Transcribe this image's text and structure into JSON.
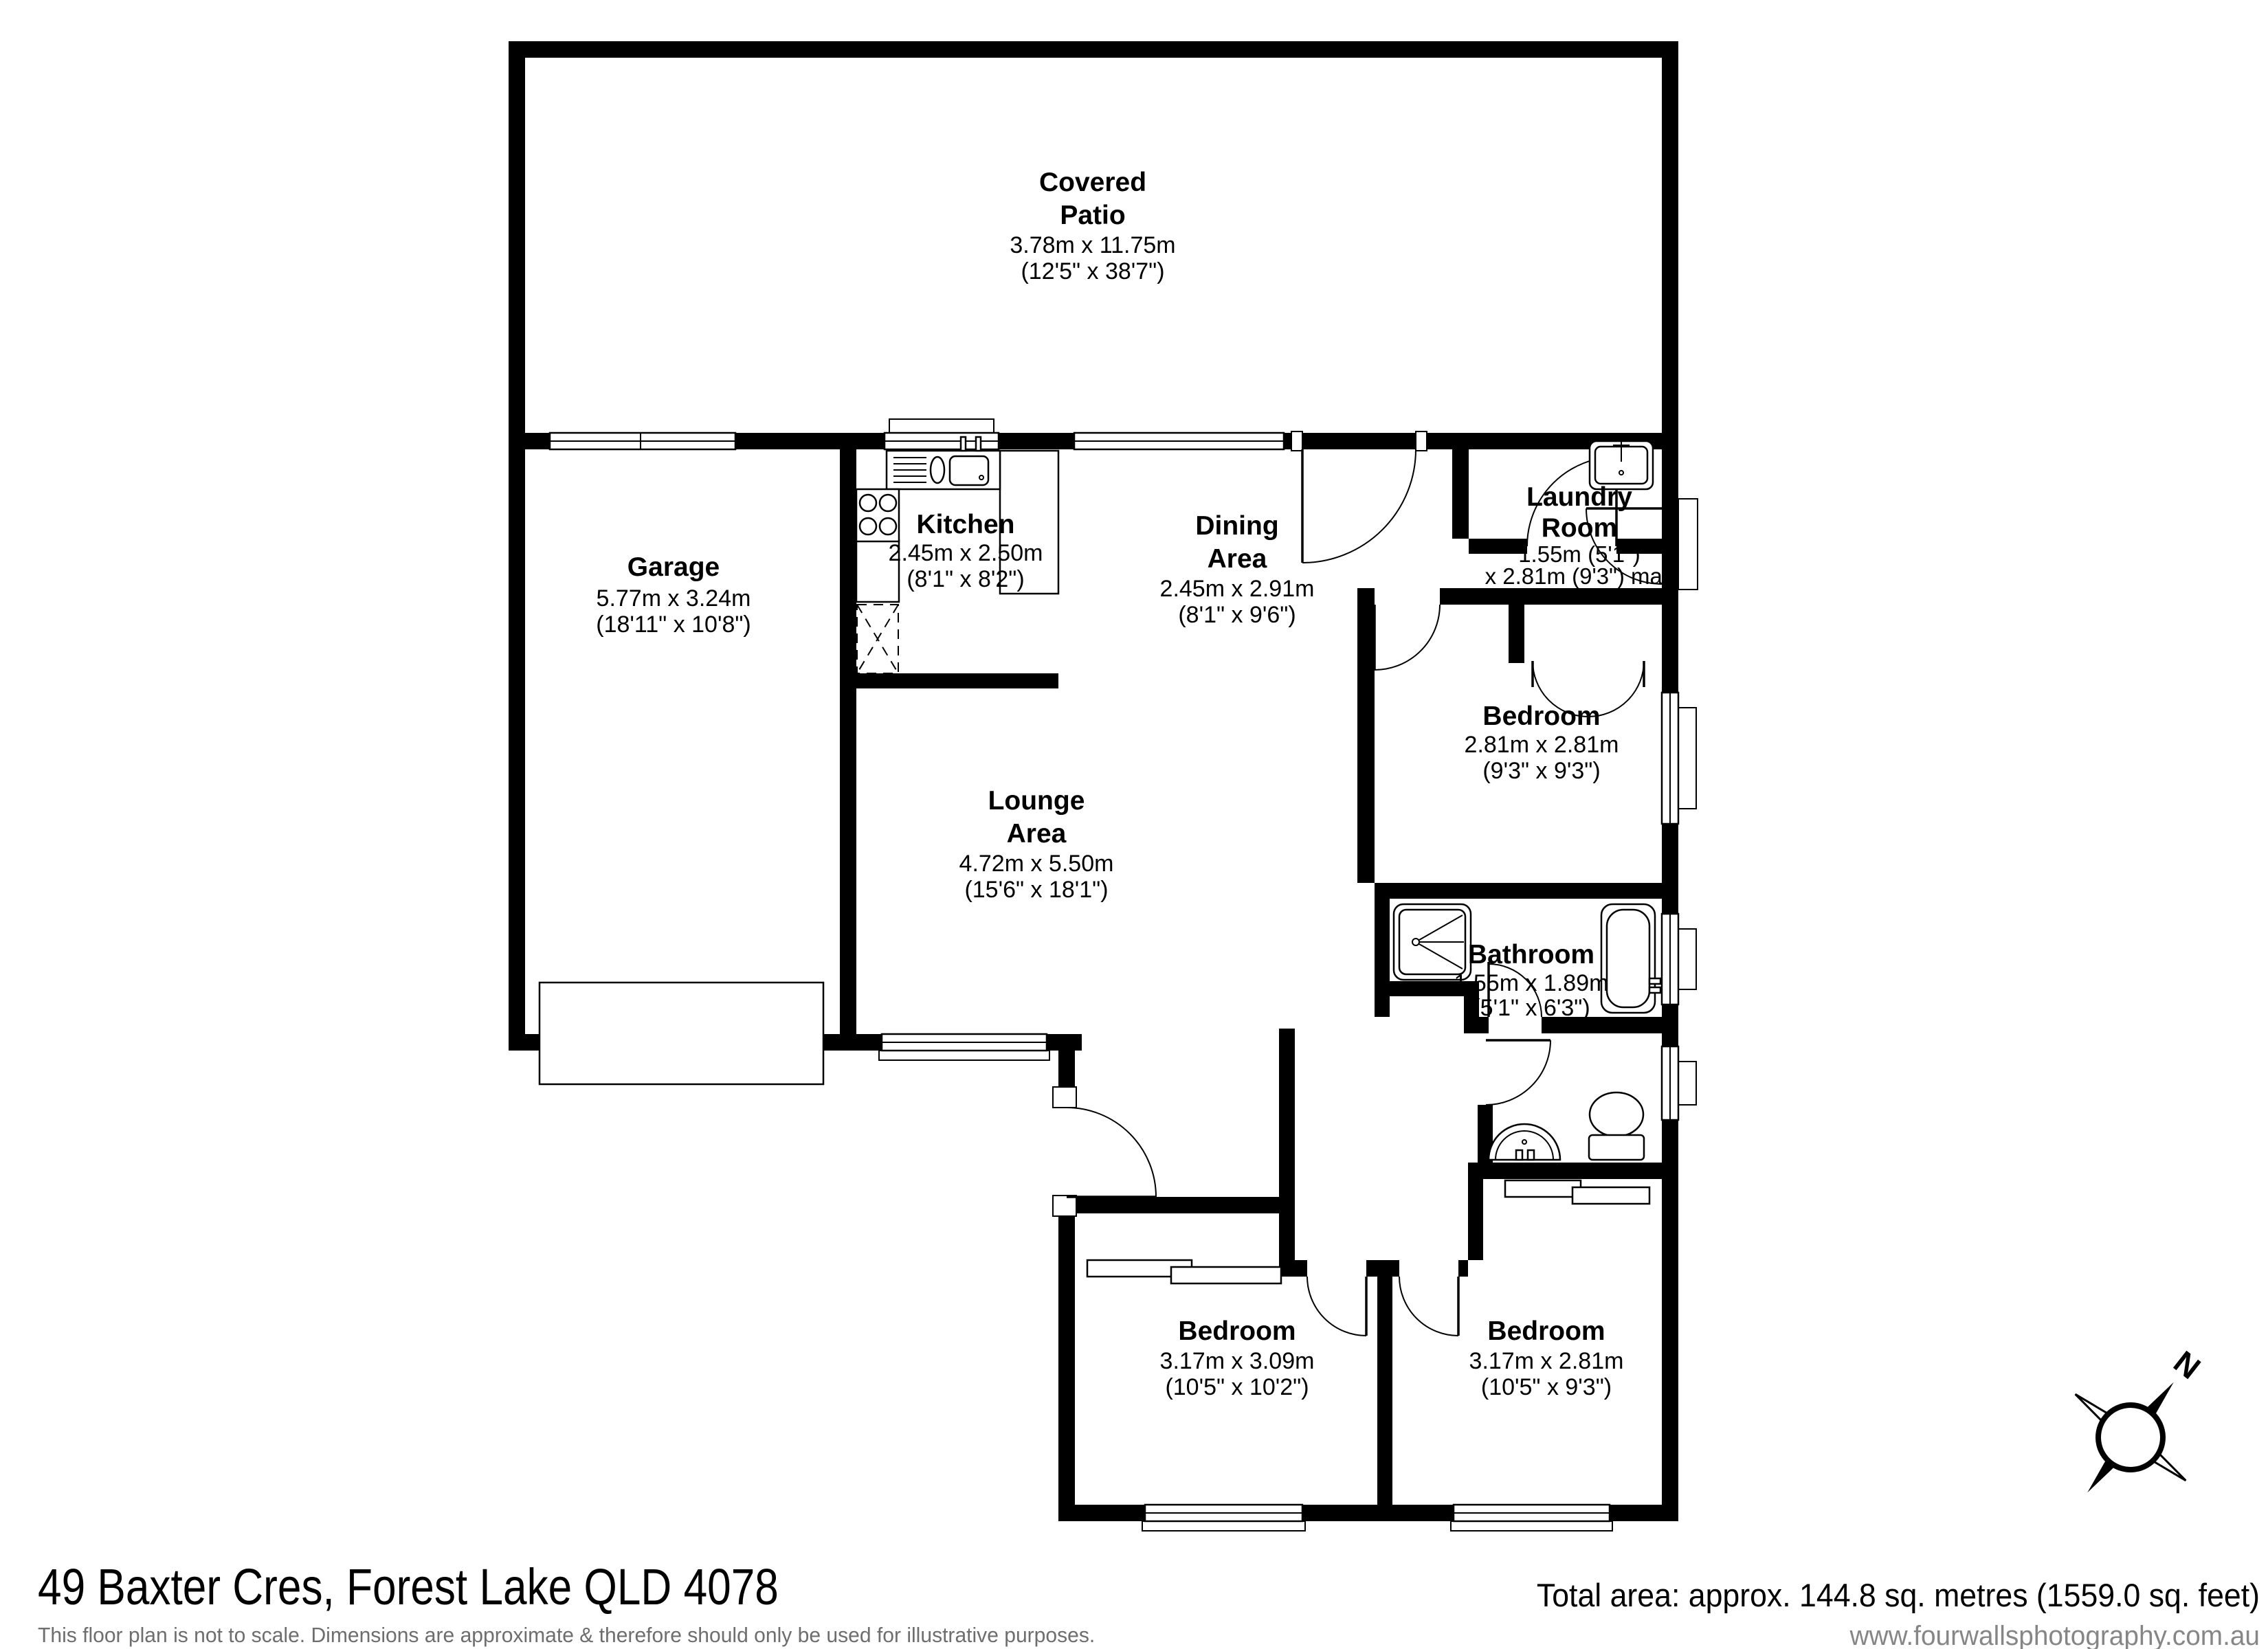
{
  "rooms": {
    "patio": {
      "line1": "Covered",
      "line2": "Patio",
      "metric": "3.78m x 11.75m",
      "imperial": "(12'5\" x 38'7\")"
    },
    "garage": {
      "line1": "Garage",
      "metric": "5.77m x 3.24m",
      "imperial": "(18'11\" x 10'8\")"
    },
    "kitchen": {
      "line1": "Kitchen",
      "metric": "2.45m x 2.50m",
      "imperial": "(8'1\" x 8'2\")"
    },
    "dining": {
      "line1": "Dining",
      "line2": "Area",
      "metric": "2.45m x 2.91m",
      "imperial": "(8'1\" x 9'6\")"
    },
    "laundry": {
      "line1": "Laundry",
      "line2": "Room",
      "metric": "1.55m (5'1\")",
      "imperial": "x 2.81m (9'3\") max"
    },
    "bedroom_ne": {
      "line1": "Bedroom",
      "metric": "2.81m x 2.81m",
      "imperial": "(9'3\" x 9'3\")"
    },
    "lounge": {
      "line1": "Lounge",
      "line2": "Area",
      "metric": "4.72m x 5.50m",
      "imperial": "(15'6\" x 18'1\")"
    },
    "bathroom": {
      "line1": "Bathroom",
      "metric": "1.55m x 1.89m",
      "imperial": "(5'1\" x 6'3\")"
    },
    "bedroom_sw": {
      "line1": "Bedroom",
      "metric": "3.17m x 3.09m",
      "imperial": "(10'5\" x 10'2\")"
    },
    "bedroom_se": {
      "line1": "Bedroom",
      "metric": "3.17m x 2.81m",
      "imperial": "(10'5\" x 9'3\")"
    }
  },
  "footer": {
    "address": "49 Baxter Cres, Forest Lake QLD 4078",
    "disclaimer": "This floor plan is not to scale. Dimensions are approximate & therefore should only be used for illustrative purposes.",
    "total_area": "Total area: approx. 144.8 sq. metres (1559.0 sq. feet)",
    "website": "www.fourwallsphotography.com.au"
  },
  "compass": {
    "label": "N"
  },
  "colors": {
    "wall": "#000000",
    "background": "#ffffff",
    "muted_text": "#6e6e6e"
  }
}
